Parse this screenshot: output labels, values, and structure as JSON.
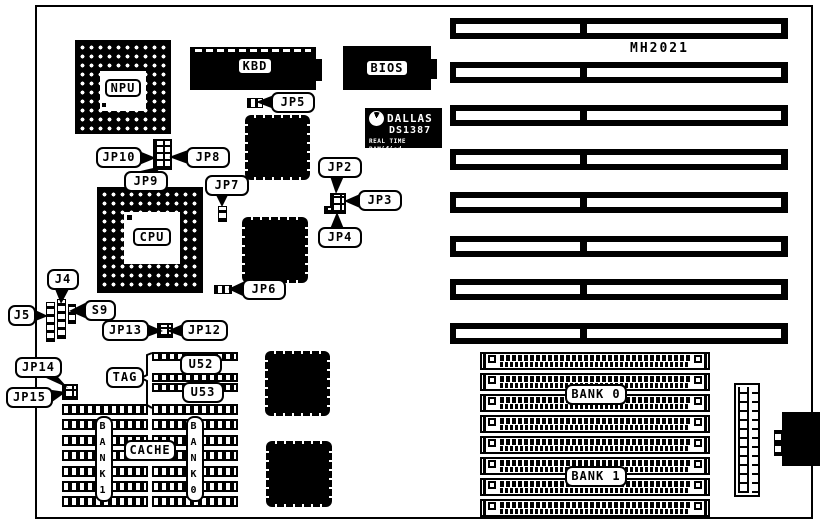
{
  "diagram": {
    "model_label": "MH2021",
    "chips": {
      "npu": "NPU",
      "cpu": "CPU",
      "kbd": "KBD",
      "bios": "BIOS"
    },
    "rtc": {
      "brand": "DALLAS",
      "model": "DS1387",
      "tagline": "REAL TIME RAMified"
    },
    "jumpers": {
      "jp2": "JP2",
      "jp3": "JP3",
      "jp4": "JP4",
      "jp5": "JP5",
      "jp6": "JP6",
      "jp7": "JP7",
      "jp8": "JP8",
      "jp9": "JP9",
      "jp10": "JP10",
      "jp12": "JP12",
      "jp13": "JP13",
      "jp14": "JP14",
      "jp15": "JP15"
    },
    "connectors": {
      "j4": "J4",
      "j5": "J5",
      "s9": "S9"
    },
    "cache": {
      "tag": "TAG",
      "u52": "U52",
      "u53": "U53",
      "cache": "CACHE",
      "bank1_vertical": "BANK1",
      "bank0_vertical": "BANK0"
    },
    "memory": {
      "bank0": "BANK 0",
      "bank1": "BANK 1"
    },
    "counts": {
      "isa_slots": 8,
      "simm_sockets": 8,
      "cache_rows": 7
    },
    "colors": {
      "ink": "#000000",
      "paper": "#ffffff"
    }
  }
}
